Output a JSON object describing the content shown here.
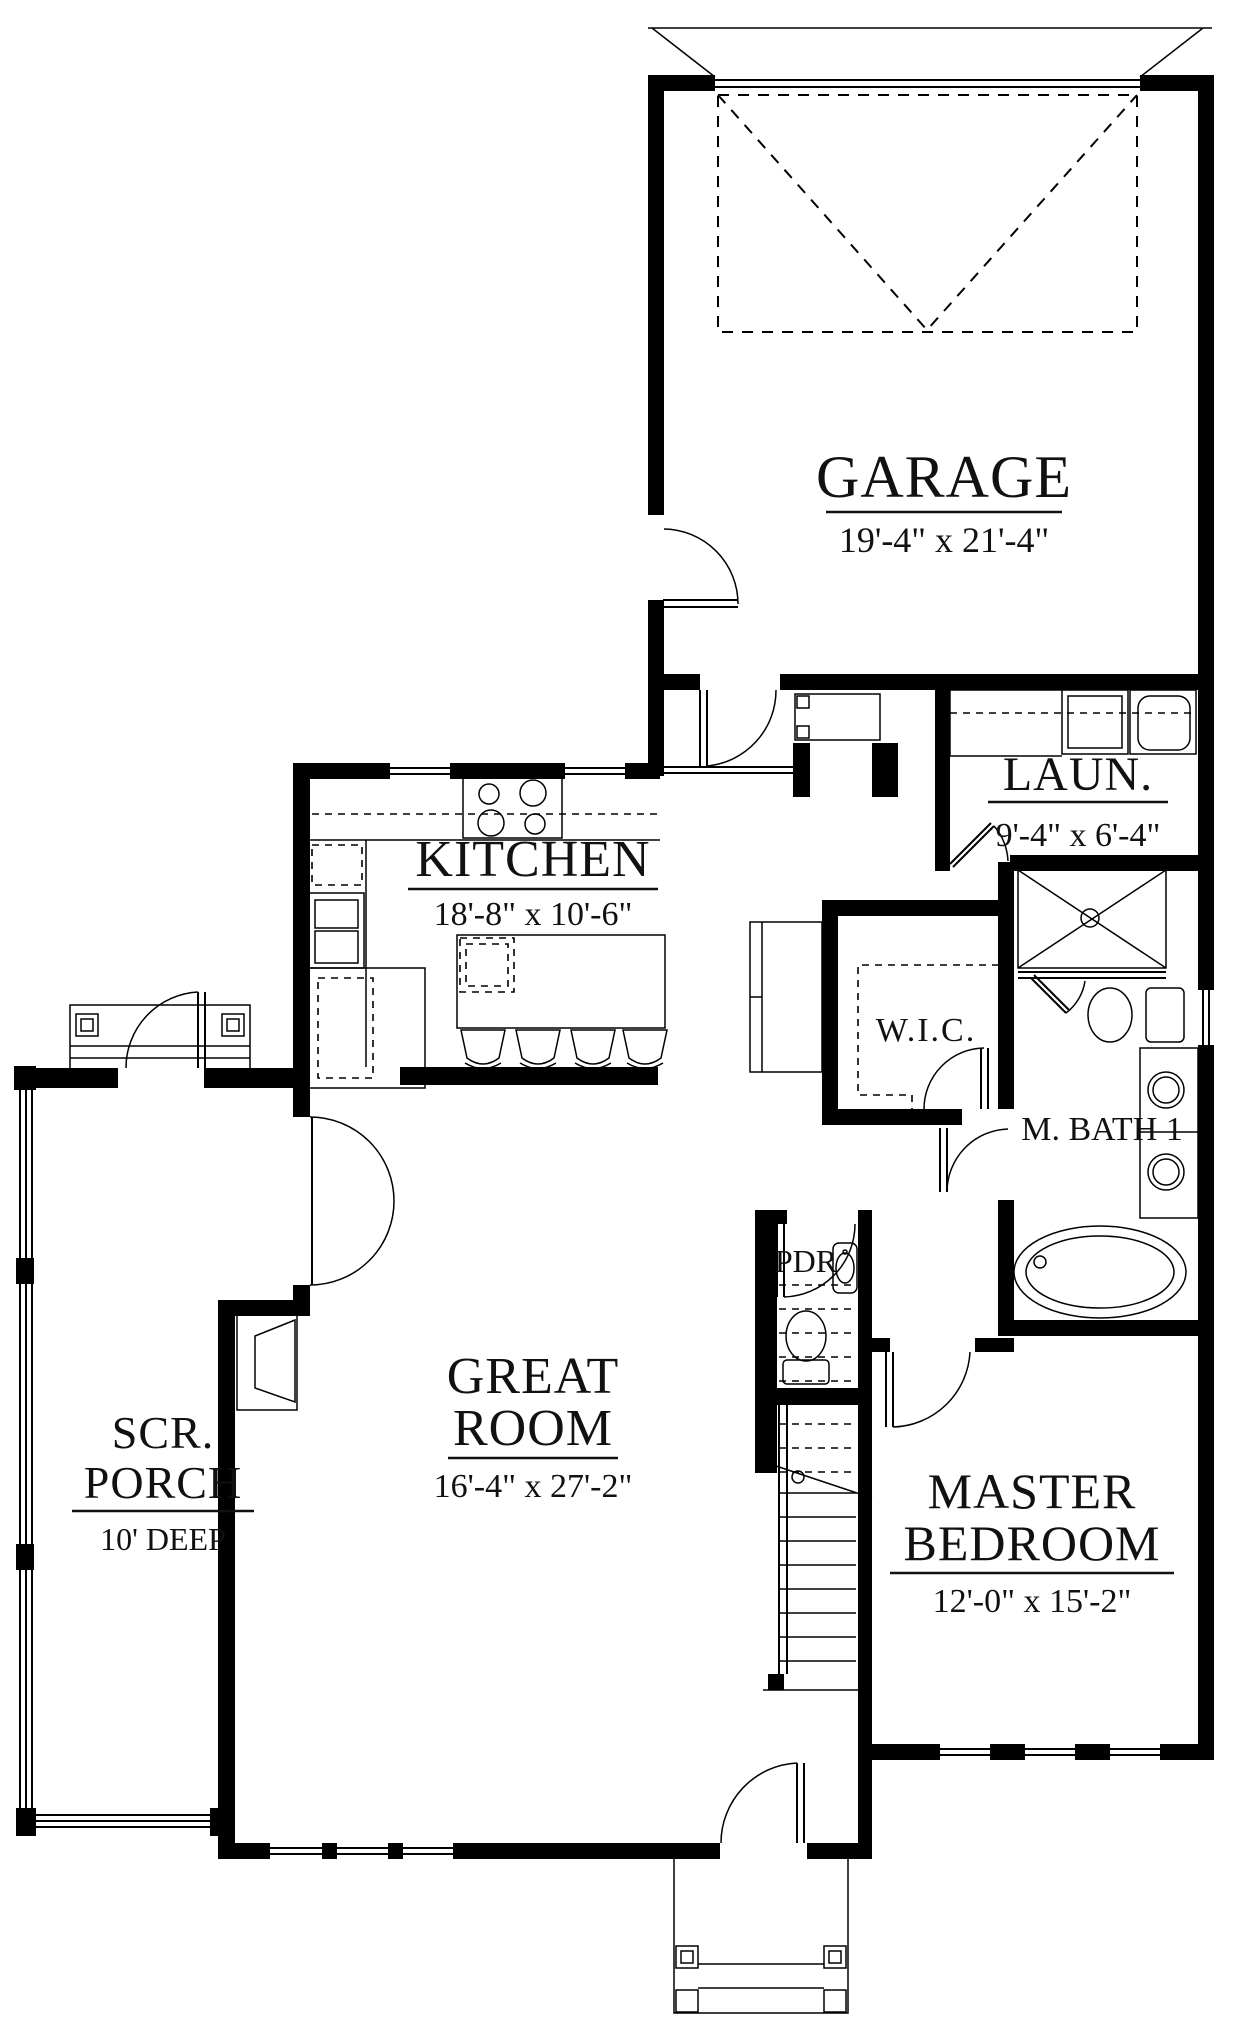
{
  "canvas": {
    "background": "#ffffff",
    "ink": "#000000"
  },
  "rooms": {
    "garage": {
      "name": "GARAGE",
      "dims": "19'-4\" x 21'-4\""
    },
    "laundry": {
      "name": "LAUN.",
      "dims": "9'-4\" x 6'-4\""
    },
    "kitchen": {
      "name": "KITCHEN",
      "dims": "18'-8\" x 10'-6\""
    },
    "wic": {
      "name": "W.I.C."
    },
    "master_bath": {
      "name": "M. BATH 1"
    },
    "powder": {
      "name": "PDR"
    },
    "great_room": {
      "name_line1": "GREAT",
      "name_line2": "ROOM",
      "dims": "16'-4\" x 27'-2\""
    },
    "screened_porch": {
      "name_line1": "SCR.",
      "name_line2": "PORCH",
      "dims": "10' DEEP"
    },
    "master_bedroom": {
      "name_line1": "MASTER",
      "name_line2": "BEDROOM",
      "dims": "12'-0\" x 15'-2\""
    }
  }
}
